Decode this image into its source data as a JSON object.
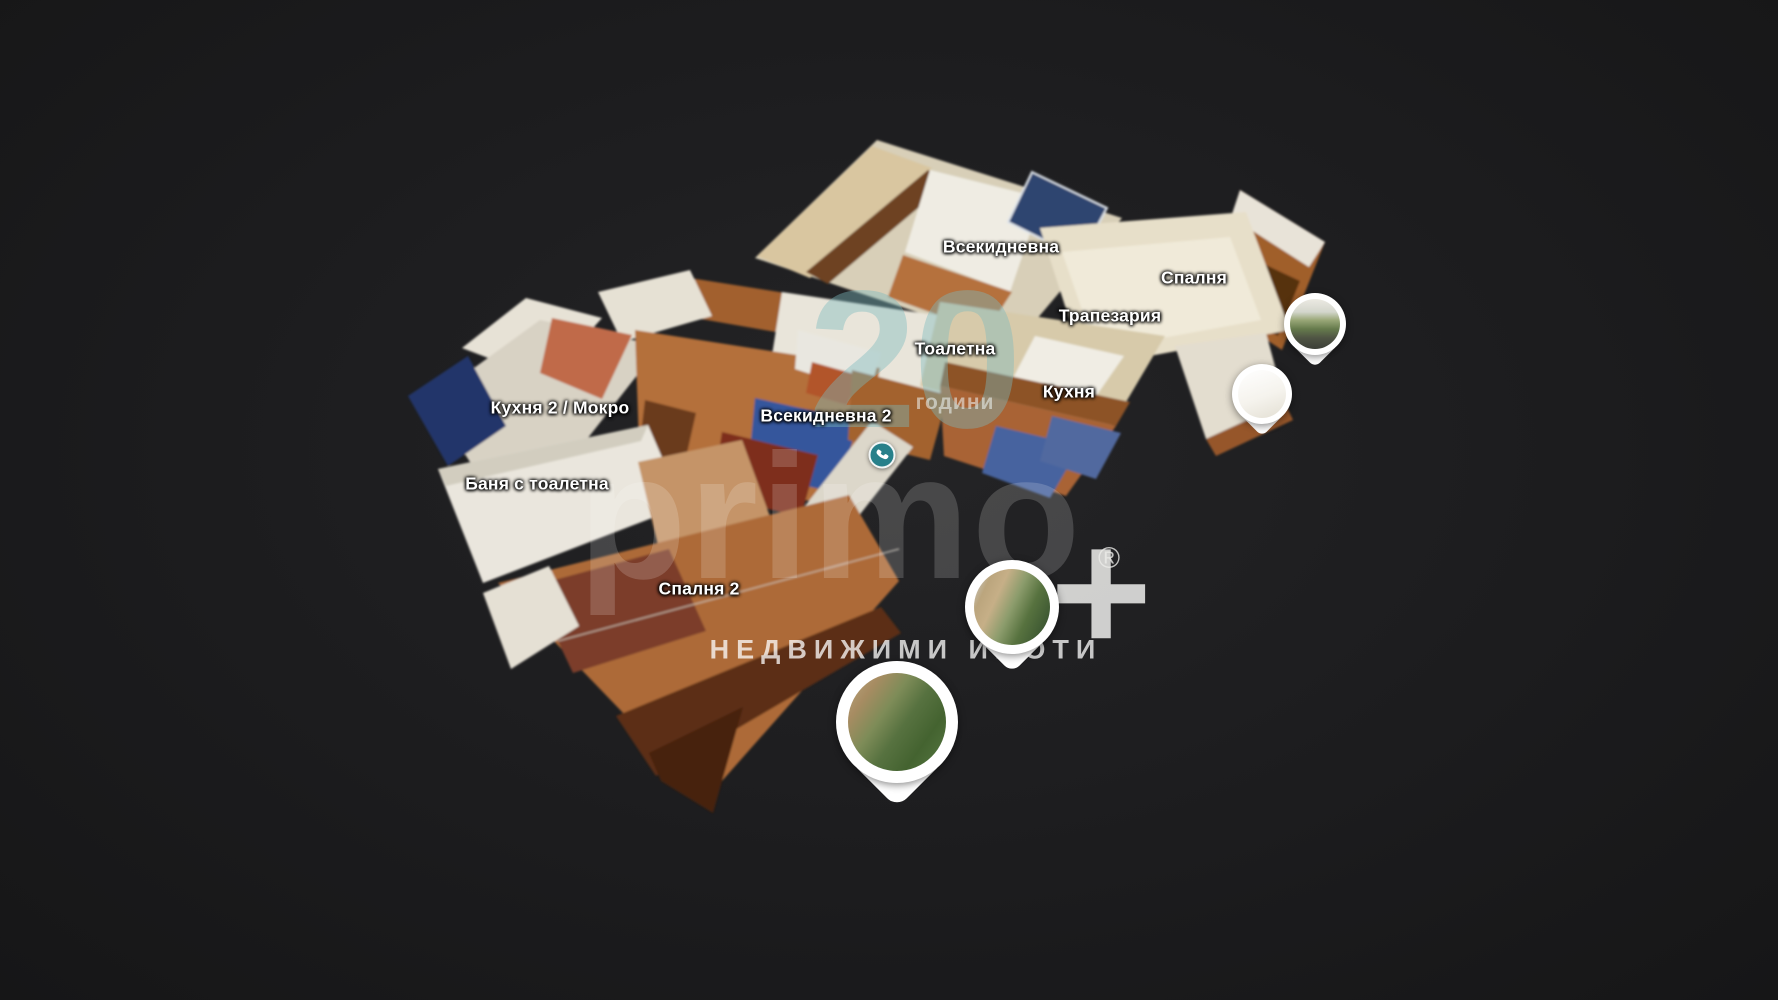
{
  "scene": {
    "background_color": "#1c1c1e"
  },
  "room_labels": [
    {
      "label": "Всекидневна",
      "x": 1001,
      "y": 247
    },
    {
      "label": "Спалня",
      "x": 1194,
      "y": 278
    },
    {
      "label": "Трапезария",
      "x": 1110,
      "y": 316
    },
    {
      "label": "Тоалетна",
      "x": 955,
      "y": 349
    },
    {
      "label": "Кухня",
      "x": 1069,
      "y": 392
    },
    {
      "label": "Кухня 2 / Мокро",
      "x": 560,
      "y": 408
    },
    {
      "label": "Всекидневна 2",
      "x": 826,
      "y": 416
    },
    {
      "label": "Баня с тоалетна",
      "x": 537,
      "y": 484
    },
    {
      "label": "Спалня 2",
      "x": 699,
      "y": 589
    }
  ],
  "markers": {
    "phone_button": {
      "icon": "phone-icon",
      "x": 882,
      "y": 455,
      "color": "#27808a"
    },
    "photo_pins": [
      {
        "photo": "terrace",
        "x": 1315,
        "y": 324,
        "size": 62
      },
      {
        "photo": "overexposed",
        "x": 1262,
        "y": 394,
        "size": 60
      },
      {
        "photo": "street",
        "x": 1012,
        "y": 607,
        "size": 94
      },
      {
        "photo": "garden",
        "x": 897,
        "y": 722,
        "size": 122
      }
    ]
  },
  "watermark": {
    "brand_text": "primo",
    "brand_plus": "+",
    "registered_mark": "®",
    "subtitle": "НЕДВИЖИМИ ИМОТИ",
    "anniversary_number": "20",
    "anniversary_label": "години",
    "accent_color": "#2a9ba1"
  }
}
